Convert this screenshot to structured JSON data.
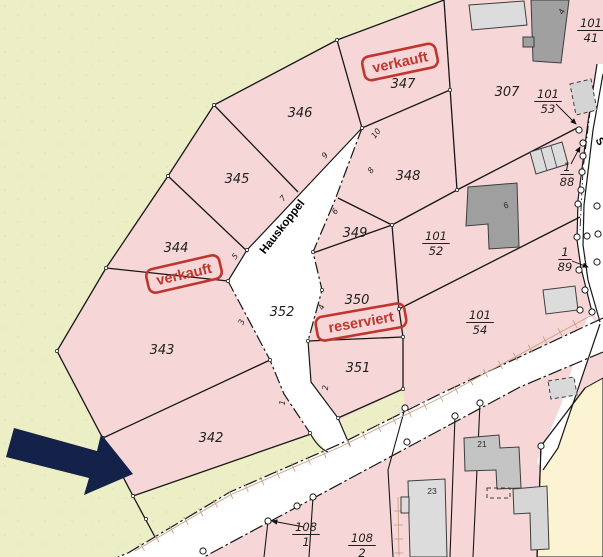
{
  "map": {
    "colors": {
      "field_green": "#ecefc6",
      "speckle": "#dce0ad",
      "parcel_pink": "#f7d6d7",
      "road_white": "#ffffff",
      "beige_area": "#fcf3d2",
      "boundary_line": "#171717",
      "stamp_red": "#c0362f",
      "arrow_navy": "#14224a",
      "hatch_tan": "#c7a183",
      "building_dark": "#a0a0a0",
      "building_light": "#dcdcdc",
      "label_color": "#1f1f1f"
    },
    "street_names": [
      {
        "text": "Hauskoppel",
        "x": 285,
        "y": 229,
        "rot": -52,
        "size": 11.5
      },
      {
        "text": "S",
        "x": 597,
        "y": 143,
        "rot": 62,
        "size": 11
      }
    ],
    "parcel_labels": [
      {
        "text": "342",
        "x": 211,
        "y": 442
      },
      {
        "text": "343",
        "x": 162,
        "y": 354
      },
      {
        "text": "344",
        "x": 176,
        "y": 252
      },
      {
        "text": "345",
        "x": 237,
        "y": 183
      },
      {
        "text": "346",
        "x": 300,
        "y": 117
      },
      {
        "text": "347",
        "x": 403,
        "y": 88
      },
      {
        "text": "348",
        "x": 408,
        "y": 180
      },
      {
        "text": "349",
        "x": 355,
        "y": 237
      },
      {
        "text": "350",
        "x": 357,
        "y": 304
      },
      {
        "text": "351",
        "x": 358,
        "y": 372
      },
      {
        "text": "352",
        "x": 282,
        "y": 316
      },
      {
        "text": "307",
        "x": 507,
        "y": 96
      }
    ],
    "fraction_labels": [
      {
        "top": "101",
        "bottom": "41",
        "x": 591,
        "y": 29
      },
      {
        "top": "101",
        "bottom": "53",
        "x": 548,
        "y": 100
      },
      {
        "top": "1",
        "bottom": "88",
        "x": 567,
        "y": 173
      },
      {
        "top": "101",
        "bottom": "52",
        "x": 436,
        "y": 242
      },
      {
        "top": "1",
        "bottom": "89",
        "x": 565,
        "y": 258
      },
      {
        "top": "101",
        "bottom": "54",
        "x": 480,
        "y": 321
      },
      {
        "top": "108",
        "bottom": "1",
        "x": 306,
        "y": 533
      },
      {
        "top": "108",
        "bottom": "2",
        "x": 362,
        "y": 544
      }
    ],
    "house_numbers": [
      {
        "text": "10",
        "x": 378,
        "y": 135,
        "rot": -52
      },
      {
        "text": "9",
        "x": 327,
        "y": 157,
        "rot": -52
      },
      {
        "text": "8",
        "x": 373,
        "y": 172,
        "rot": -52
      },
      {
        "text": "7",
        "x": 285,
        "y": 200,
        "rot": -50
      },
      {
        "text": "6",
        "x": 337,
        "y": 213,
        "rot": -50
      },
      {
        "text": "5",
        "x": 237,
        "y": 258,
        "rot": -50
      },
      {
        "text": "4",
        "x": 324,
        "y": 308,
        "rot": -72
      },
      {
        "text": "3",
        "x": 244,
        "y": 323,
        "rot": -68
      },
      {
        "text": "2",
        "x": 328,
        "y": 388,
        "rot": -84
      },
      {
        "text": "1",
        "x": 285,
        "y": 403,
        "rot": -84
      }
    ],
    "building_numbers": [
      {
        "text": "21",
        "x": 482,
        "y": 447,
        "rot": 0
      },
      {
        "text": "23",
        "x": 432,
        "y": 494,
        "rot": 0
      },
      {
        "text": "4",
        "x": 564,
        "y": 13,
        "rot": -58
      },
      {
        "text": "6",
        "x": 507,
        "y": 208,
        "rot": -20
      }
    ],
    "stamps": [
      {
        "text": "verkauft",
        "x": 400,
        "y": 62,
        "rot": -12
      },
      {
        "text": "verkauft",
        "x": 184,
        "y": 274,
        "rot": -13
      },
      {
        "text": "reserviert",
        "x": 361,
        "y": 322,
        "rot": -10
      }
    ]
  }
}
